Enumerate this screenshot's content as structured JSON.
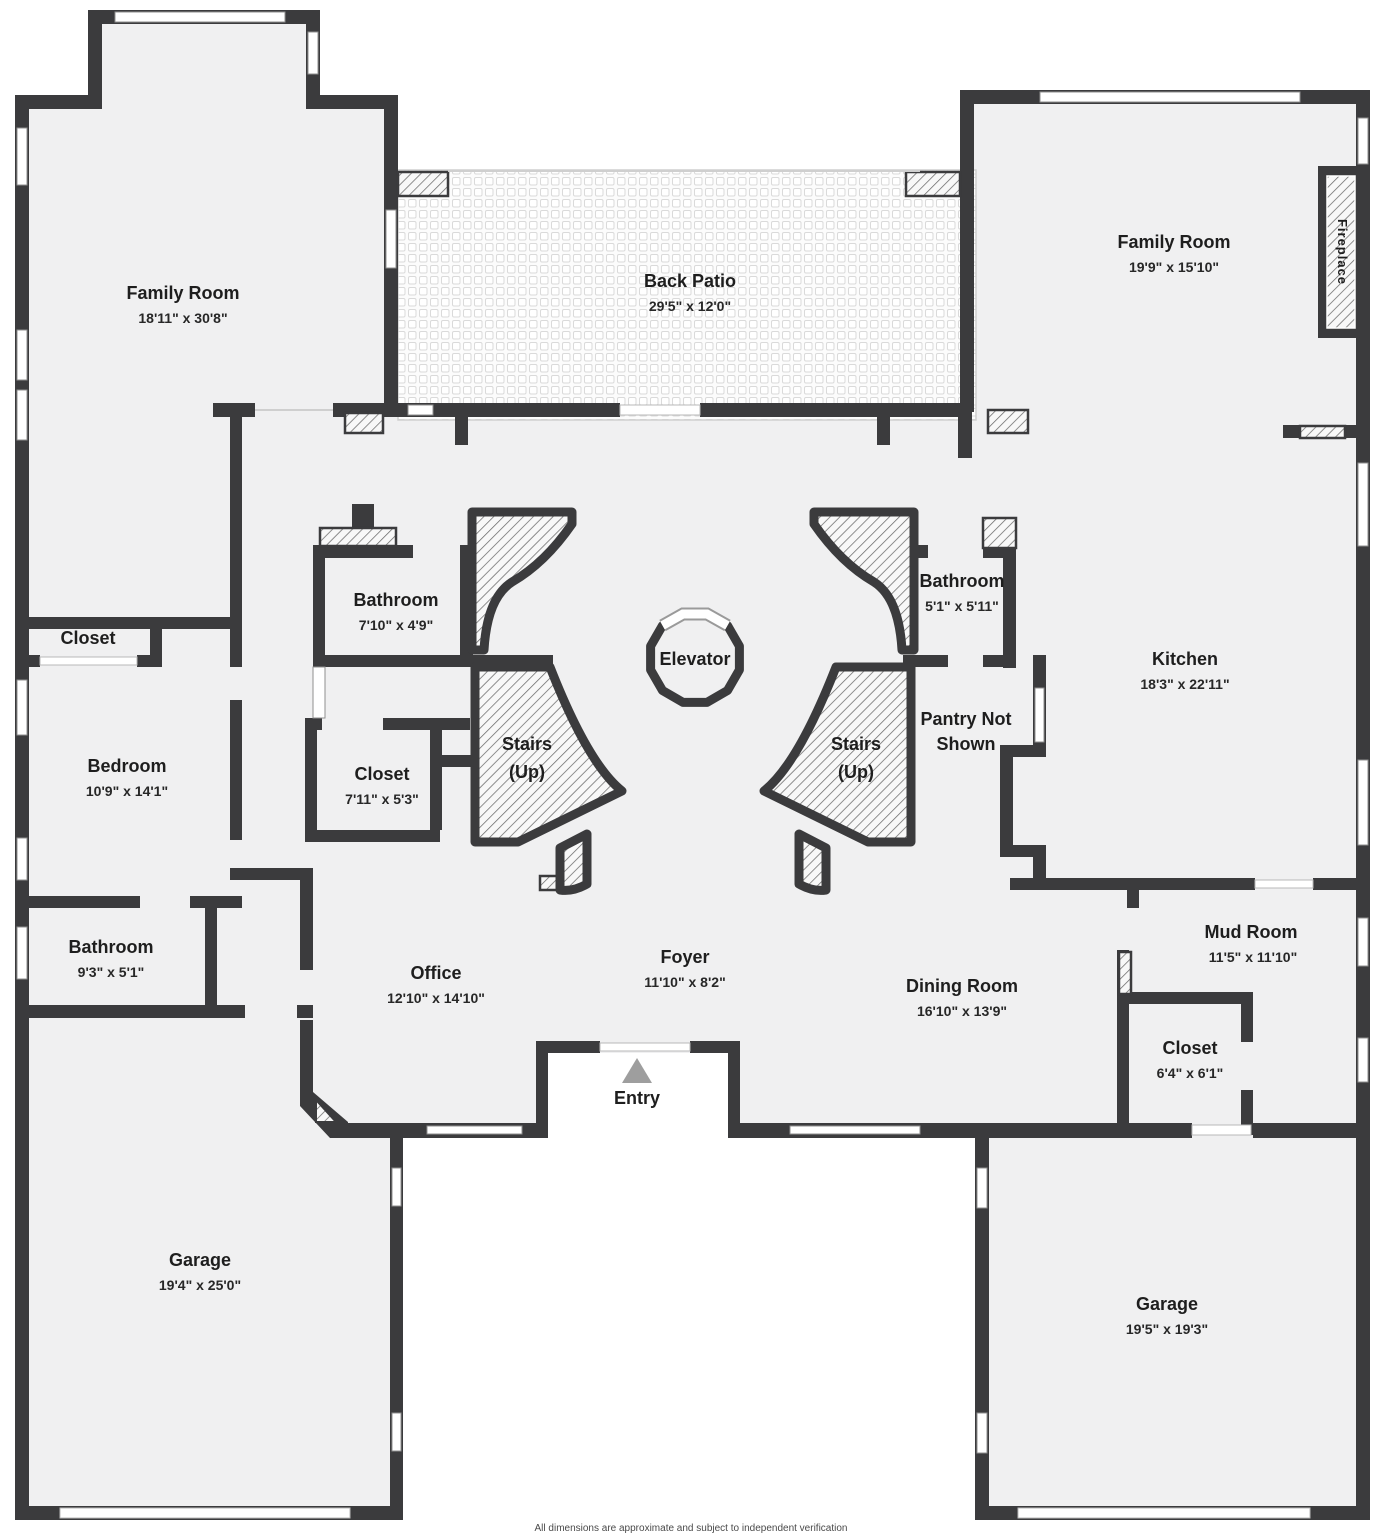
{
  "palette": {
    "wall": "#3b3b3d",
    "floor": "#f0f0f1",
    "background": "#ffffff",
    "hatch_line": "#6a6a6a",
    "label_text": "#1e1e1e",
    "entry_arrow": "#9e9e9e"
  },
  "rooms": [
    {
      "id": "family-room-left",
      "name": "Family Room",
      "dims": "18'11\" x 30'8\""
    },
    {
      "id": "back-patio",
      "name": "Back Patio",
      "dims": "29'5\" x 12'0\""
    },
    {
      "id": "family-room-right",
      "name": "Family Room",
      "dims": "19'9\" x 15'10\""
    },
    {
      "id": "closet-top-left",
      "name": "Closet",
      "dims": ""
    },
    {
      "id": "bedroom",
      "name": "Bedroom",
      "dims": "10'9\" x 14'1\""
    },
    {
      "id": "bathroom-left",
      "name": "Bathroom",
      "dims": "9'3\" x 5'1\""
    },
    {
      "id": "bathroom-center",
      "name": "Bathroom",
      "dims": "7'10\" x 4'9\""
    },
    {
      "id": "closet-center",
      "name": "Closet",
      "dims": "7'11\" x 5'3\""
    },
    {
      "id": "kitchen",
      "name": "Kitchen",
      "dims": "18'3\" x 22'11\""
    },
    {
      "id": "bathroom-right",
      "name": "Bathroom",
      "dims": "5'1\" x 5'11\""
    },
    {
      "id": "office",
      "name": "Office",
      "dims": "12'10\" x 14'10\""
    },
    {
      "id": "foyer",
      "name": "Foyer",
      "dims": "11'10\" x 8'2\""
    },
    {
      "id": "dining-room",
      "name": "Dining Room",
      "dims": "16'10\" x 13'9\""
    },
    {
      "id": "mud-room",
      "name": "Mud Room",
      "dims": "11'5\" x 11'10\""
    },
    {
      "id": "closet-right",
      "name": "Closet",
      "dims": "6'4\" x 6'1\""
    },
    {
      "id": "garage-left",
      "name": "Garage",
      "dims": "19'4\" x 25'0\""
    },
    {
      "id": "garage-right",
      "name": "Garage",
      "dims": "19'5\" x 19'3\""
    }
  ],
  "features": {
    "stairs_left": {
      "line1": "Stairs",
      "line2": "(Up)"
    },
    "stairs_right": {
      "line1": "Stairs",
      "line2": "(Up)"
    },
    "pantry": {
      "line1": "Pantry Not",
      "line2": "Shown"
    },
    "elevator": {
      "label": "Elevator"
    },
    "entry": {
      "label": "Entry"
    },
    "fireplace": {
      "label": "Fireplace"
    }
  },
  "footer": {
    "disclaimer": "All dimensions are approximate and subject to independent verification"
  }
}
